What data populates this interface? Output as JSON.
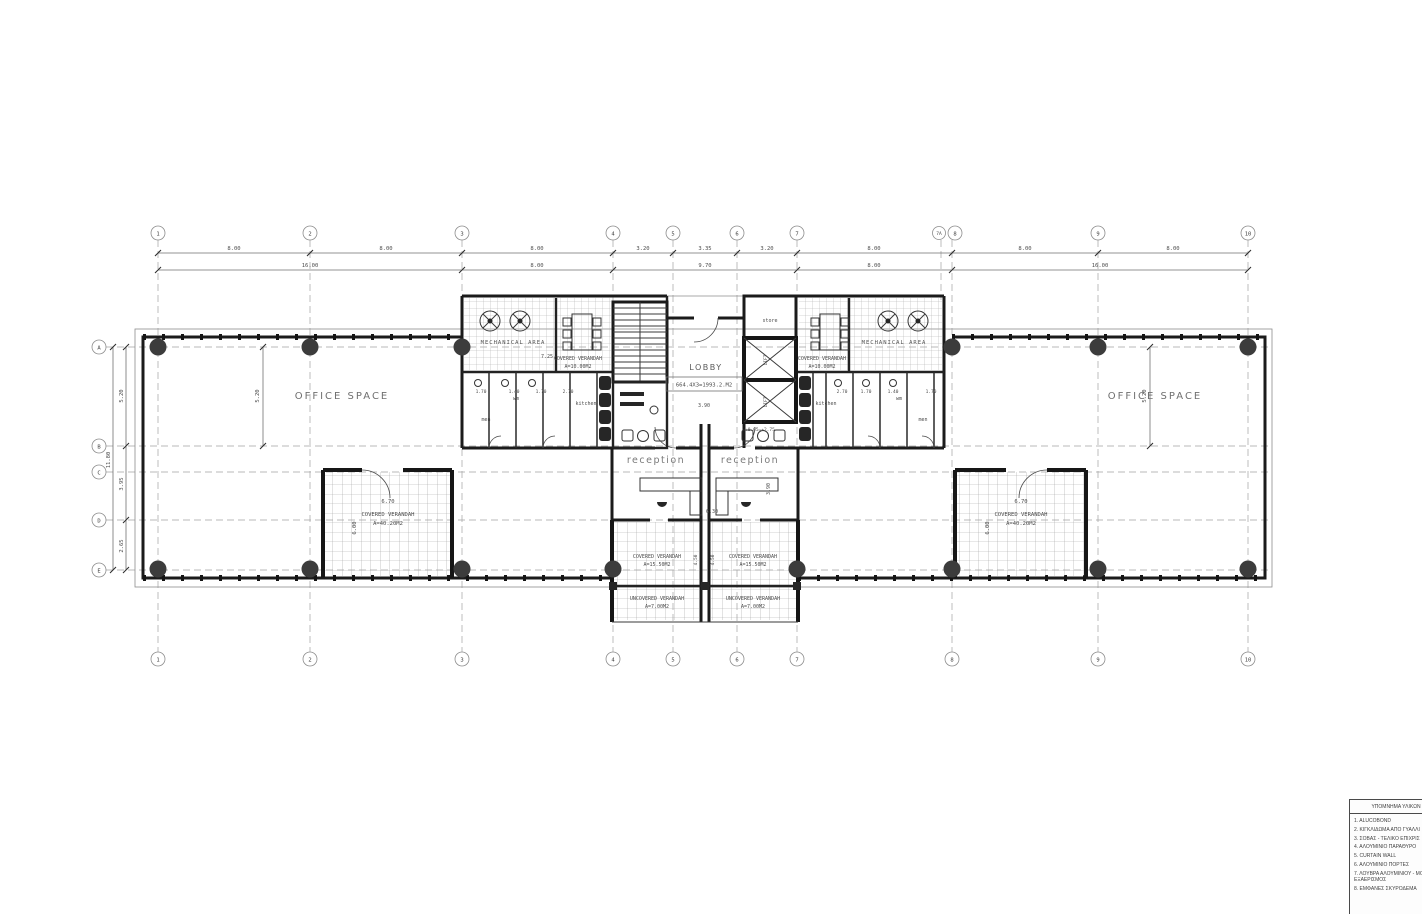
{
  "drawing": {
    "grid_columns_top": [
      "1",
      "2",
      "3",
      "4",
      "5",
      "6",
      "7",
      "7A",
      "8",
      "9",
      "10"
    ],
    "grid_columns_bottom": [
      "1",
      "2",
      "3",
      "4",
      "5",
      "6",
      "7",
      "8",
      "9",
      "10"
    ],
    "grid_rows": [
      "A",
      "B",
      "C",
      "D",
      "E"
    ],
    "dims": {
      "top_row1": [
        "8.00",
        "8.00",
        "8.00",
        "3.20",
        "3.35",
        "3.20",
        "8.00",
        "8.00",
        "8.00"
      ],
      "top_row2": [
        "16.00",
        "8.00",
        "9.70",
        "8.00",
        "16.00"
      ],
      "left_overall": "11.80",
      "left_segments": [
        "5.20",
        "3.95",
        "2.65"
      ],
      "wing_bay": "5.20"
    },
    "rooms": {
      "office": "OFFICE SPACE",
      "mechanical": "MECHANICAL AREA",
      "lobby": "LOBBY",
      "lobby_area": "664.4X3=1993.2.M2",
      "store": "store",
      "lift": "LIFT",
      "lift_level": "+0.05=+2.75",
      "reception": "reception",
      "kitchen": "kitchen",
      "wm": "wm",
      "men": "men"
    },
    "verandahs": {
      "covered": "COVERED VERANDAH",
      "uncovered": "UNCOVERED VERANDAH",
      "area_side": "A=40.20M2",
      "area_core": "A=10.00M2",
      "area_center_covered": "A=15.50M2",
      "area_center_uncovered": "A=7.00M2"
    },
    "annotations": {
      "d670": "6.70",
      "d600": "6.00",
      "d725": "7.25",
      "d630": "6.30",
      "d390": "3.90",
      "d450": "4.50",
      "toilet_dims_left": [
        "1.70",
        "1.40",
        "1.70",
        "2.70"
      ],
      "toilet_dims_right": [
        "2.70",
        "1.70",
        "1.40",
        "1.70"
      ]
    }
  },
  "legend": {
    "title": "ΥΠΟΜΝΗΜΑ ΥΛΙΚΩΝ",
    "items": [
      "1. ALUCOBOND",
      "2. ΚΙΓΚΛΙΔΩΜΑ ΑΠΟ ΓΥΑΛΛΙ",
      "3. ΣΟΒΑΣ - ΤΕΛΙΚΟ ΕΠΙΧΡΙΣ",
      "4. ΑΛΟΥΜΙΝΙΟ ΠΑΡΑΘΥΡΟ",
      "5. CURTAIN WALL",
      "6. ΑΛΟΥΜΙΝΙΟ ΠΟΡΤΕΣ",
      "7. ΛΟΥΒΡΑ ΑΛΟΥΜΙΝΙΟΥ - ΜΟΝΙΜΟΣ ΕΞΑΕΡΙΣΜΟΣ",
      "8. ΕΜΦΑΝΕΣ ΣΚΥΡΟΔΕΜΑ"
    ]
  }
}
